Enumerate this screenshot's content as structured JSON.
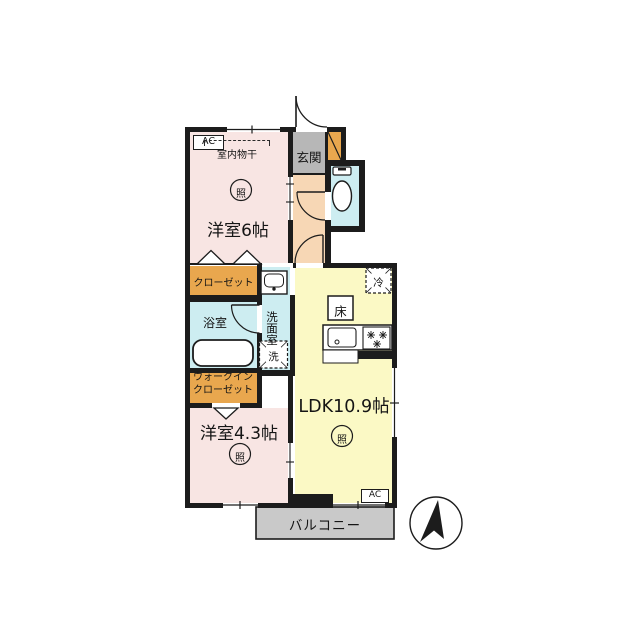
{
  "labels": {
    "room6": "洋室6帖",
    "room43": "洋室4.3帖",
    "ldk": "LDK10.9帖",
    "genkan": "玄関",
    "closet": "クローゼット",
    "wic": "ウォークイン\nクローゼット",
    "bath": "浴室",
    "washroom": "洗面室",
    "washer": "洗",
    "fridge": "冷",
    "floor_hatch": "床",
    "balcony": "バルコニー",
    "indoor_drying": "室内物干",
    "ac": "AC",
    "light": "照"
  },
  "colors": {
    "wall": "#1c1c1c",
    "room_pink": "#f8e5e3",
    "closet_orange": "#e9a74e",
    "genkan_gray": "#b7b7b7",
    "hallway_peach": "#f7d7b5",
    "wet_cyan": "#cdedf1",
    "ldk_yellow": "#fbf9c5",
    "balcony_gray": "#c9c9c9"
  }
}
